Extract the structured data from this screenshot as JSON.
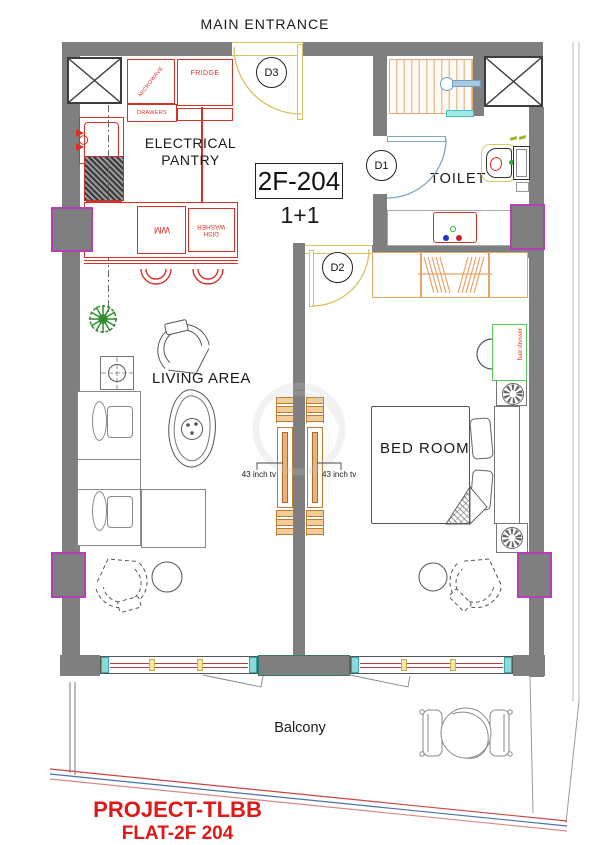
{
  "plan": {
    "entrance_label": "MAIN ENTRANCE",
    "unit_number": "2F-204",
    "unit_type": "1+1",
    "footer_line1": "PROJECT-TLBB",
    "footer_line2": "FLAT-2F 204"
  },
  "rooms": {
    "pantry_line1": "ELECTRICAL",
    "pantry_line2": "PANTRY",
    "toilet": "TOILET",
    "living": "LIVING AREA",
    "bedroom": "BED ROOM",
    "balcony": "Balcony"
  },
  "doors": {
    "d1": "D1",
    "d2": "D2",
    "d3": "D3"
  },
  "kitchen": {
    "microwave": "MICROWAVE",
    "fridge": "FRIDGE",
    "drawers": "DRAWERS",
    "washing_machine": "WM",
    "dishwasher_line1": "DISH",
    "dishwasher_line2": "WASHER"
  },
  "furniture": {
    "hair_dresser": "hair dresser",
    "tv_left_label": "43 inch tv",
    "tv_right_label": "43 inch tv"
  },
  "colors": {
    "wall_gray": "#7f7f7f",
    "annotation_red": "#d93025",
    "column_accent_magenta": "#b83db8",
    "wood_tan": "#e8a468",
    "door_arc_yellow": "#d9c060",
    "door_arc_blue": "#7aa7c8",
    "glass_cyan": "#8adada",
    "dresser_green": "#58c858",
    "plant_green": "#2e8b2e",
    "footer_red": "#e01818"
  }
}
